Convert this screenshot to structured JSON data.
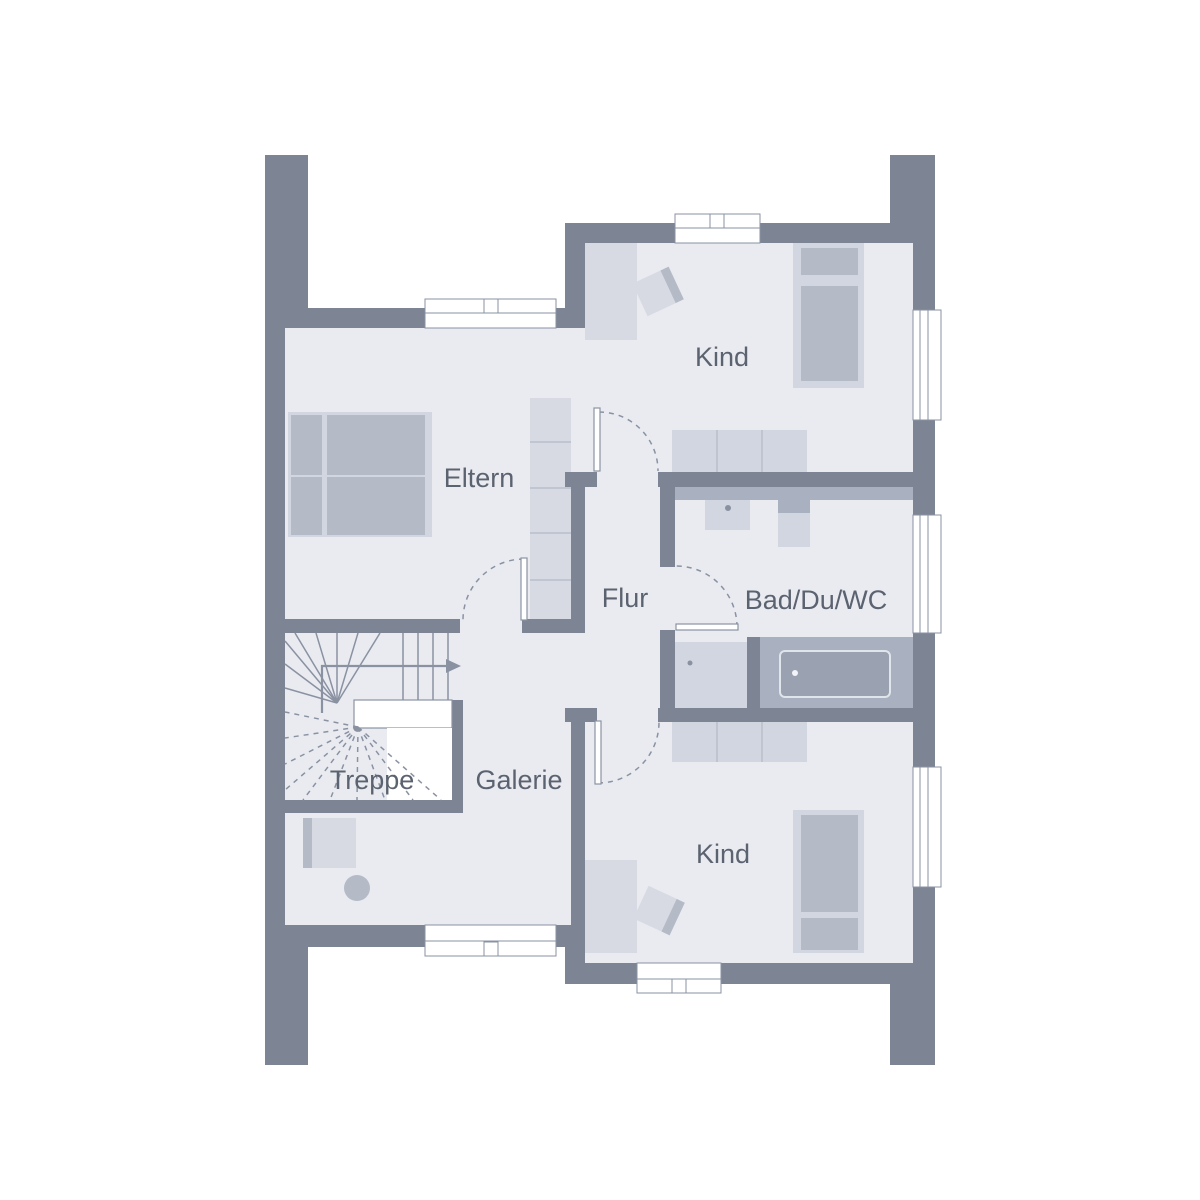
{
  "plan": {
    "type": "floor-plan",
    "storey": "upper-floor"
  },
  "rooms": {
    "eltern": {
      "label": "Eltern"
    },
    "kind_top": {
      "label": "Kind"
    },
    "flur": {
      "label": "Flur"
    },
    "bad": {
      "label": "Bad/Du/WC"
    },
    "treppe": {
      "label": "Treppe"
    },
    "galerie": {
      "label": "Galerie"
    },
    "kind_bottom": {
      "label": "Kind"
    }
  },
  "colors": {
    "background": "#ffffff",
    "wall": "#7d8594",
    "floor": "#e9ebf1",
    "furniture_light": "#d7dae3",
    "furniture_base": "#d2d6e0",
    "furniture_mid": "#b4bac6",
    "fixture_dark": "#a9b0bf",
    "tub_inner": "#9aa2b1",
    "line": "#8a92a2",
    "text": "#5c6370"
  }
}
